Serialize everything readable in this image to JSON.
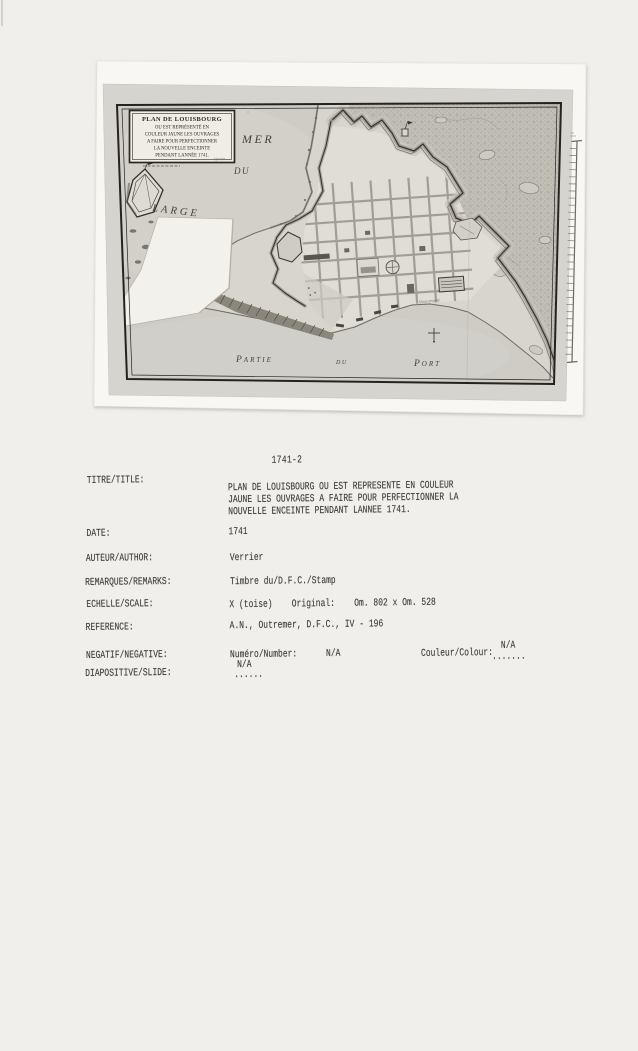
{
  "page": {
    "background_color": "#f0efec",
    "photo_paper_color": "#f8f7f4",
    "map_paper_color": "#d6d4ce",
    "ink_color": "#413f3d"
  },
  "map": {
    "cartouche": {
      "lines": [
        "PLAN DE LOUISBOURG",
        "OU EST REPRÉSENTÉ EN",
        "COULEUR JAUNE LES OUVRAGES",
        "A FAIRE POUR PERFECTIONNER",
        "LA NOUVELLE ENCEINTE",
        "PENDANT LANNÉE 1741."
      ],
      "signature": "Verrier"
    },
    "labels": {
      "mer": "MER",
      "du": "DU",
      "large": "LARGE",
      "partie": "Partie",
      "du2": "du",
      "port": "Port",
      "quay": "Quay projeté"
    },
    "icons": {
      "harbor_cross": "cross-marker",
      "scale_ruler": "photo-scale-ruler",
      "island_fort": "island-battery-outline"
    }
  },
  "catalog": {
    "number": "1741-2",
    "rows": [
      {
        "label": "TITRE/TITLE:",
        "value_lines": [
          "PLAN DE LOUISBOURG OU EST REPRESENTE EN COULEUR",
          "JAUNE LES OUVRAGES A FAIRE POUR PERFECTIONNER LA",
          "NOUVELLE ENCEINTE PENDANT LANNEE 1741."
        ]
      },
      {
        "label": "DATE:",
        "value_lines": [
          "1741"
        ]
      },
      {
        "label": "AUTEUR/AUTHOR:",
        "value_lines": [
          "Verrier"
        ]
      },
      {
        "label": "REMARQUES/REMARKS:",
        "value_lines": [
          "Timbre du/D.F.C./Stamp"
        ]
      },
      {
        "label": "ECHELLE/SCALE:",
        "value_lines": [
          "X (toise)    Original:    Om. 802 x Om. 528"
        ]
      },
      {
        "label": "REFERENCE:",
        "value_lines": [
          "A.N., Outremer, D.F.C., IV - 196"
        ]
      },
      {
        "label": "NEGATIF/NEGATIVE:",
        "value_lines": [
          "Numéro/Number:      N/A"
        ],
        "extra": {
          "label": "Couleur/Colour:",
          "dots": ".......",
          "value": "N/A"
        }
      },
      {
        "label": "DIAPOSITIVE/SLIDE:",
        "value_lines": [],
        "slide": {
          "value": "N/A",
          "dots": "......"
        }
      }
    ]
  }
}
